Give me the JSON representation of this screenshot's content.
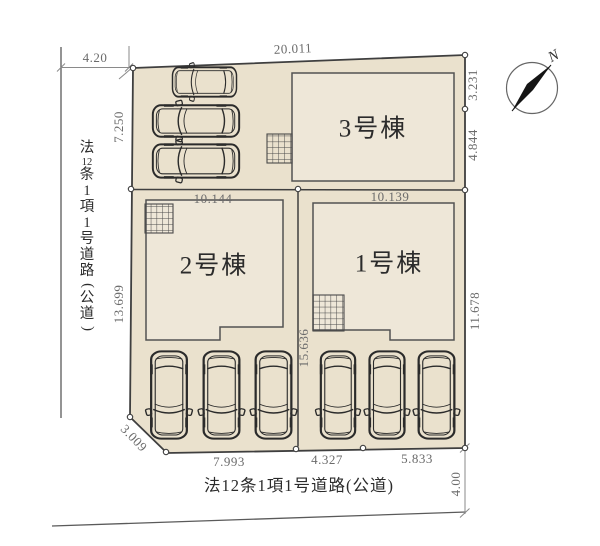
{
  "plan": {
    "buildings": [
      {
        "label": "1号棟"
      },
      {
        "label": "2号棟"
      },
      {
        "label": "3号棟"
      }
    ],
    "dims": {
      "top": "20.011",
      "top_left": "4.20",
      "left_upper": "7.250",
      "left_lower": "13.699",
      "chamfer": "3.009",
      "lot2_width": "10.144",
      "lot1_width": "10.139",
      "right_upper": "3.231",
      "right_mid": "4.844",
      "right_lower": "11.678",
      "center_depth": "15.636",
      "bottom_left": "7.993",
      "bottom_center": "4.327",
      "bottom_right": "5.833",
      "road_width": "4.00"
    },
    "roads": {
      "bottom_label": "法12条1項1号道路(公道)",
      "left_label": "法12条1項1号道路(公道)",
      "left_segments": [
        "法",
        "12",
        "条",
        "1",
        "項",
        "1",
        "号",
        "道",
        "路",
        "(",
        "公",
        "道",
        ")"
      ]
    },
    "compass": {
      "label": "N"
    },
    "icons": {
      "compass": "compass-needle",
      "car": "top-view-car",
      "hatch": "grid-hatch"
    },
    "colors": {
      "lot_fill": "#eae1cd",
      "building_fill": "#eee7d8",
      "outline": "#3f3f3f",
      "building_outline": "#525252",
      "dim_text": "#6b6b6b",
      "text": "#2b2b2b",
      "car_line": "#2b2b2b",
      "road_line": "#5a5a5a"
    }
  }
}
